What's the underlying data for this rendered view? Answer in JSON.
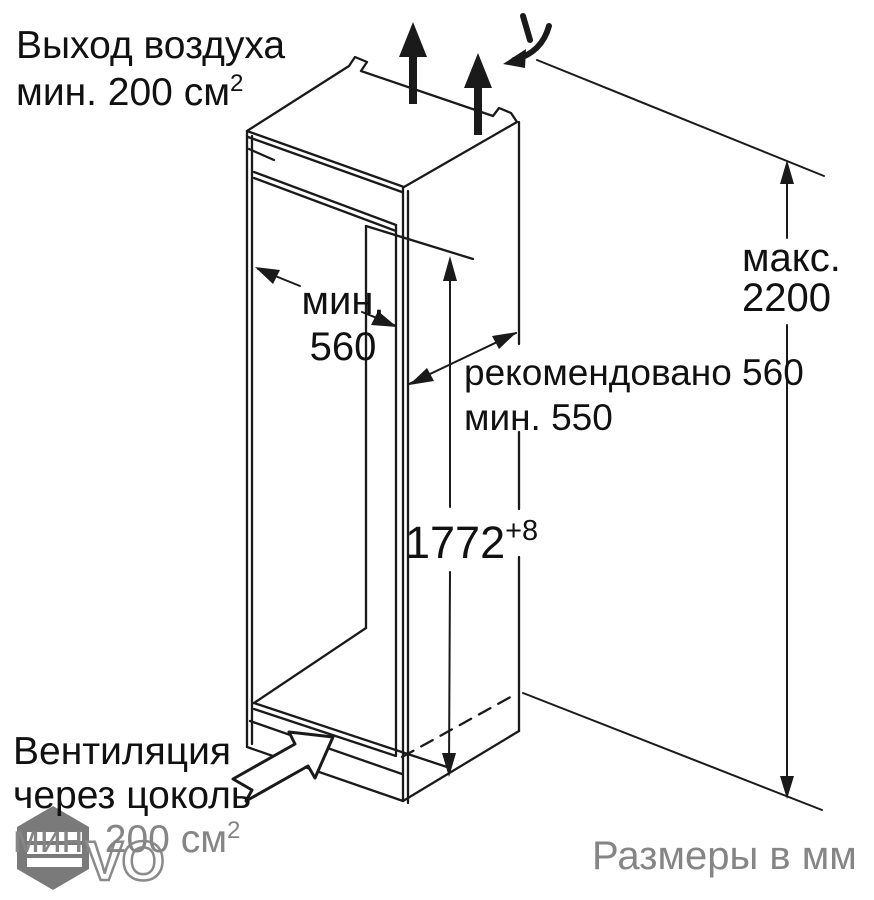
{
  "diagram_title": "Схема установки встраиваемого холодильника (ниша)",
  "units_note": "Размеры в мм",
  "annotations": {
    "air_outlet": {
      "line1": "Выход воздуха",
      "line2": "мин. 200 см",
      "sup": "2"
    },
    "niche_width": {
      "line1": "мин.",
      "line2": "560"
    },
    "niche_depth": {
      "line1": "рекомендовано 560",
      "line2": "мин. 550"
    },
    "niche_height": {
      "value": "1772",
      "tolerance": "+8"
    },
    "max_height": {
      "line1": "макс.",
      "line2": "2200"
    },
    "plinth_vent": {
      "line1": "Вентиляция",
      "line2": "через цоколь",
      "line3": "мин. 200 см",
      "sup": "2"
    }
  },
  "dimensions_mm": {
    "niche_width_min": 560,
    "niche_depth_recommended": 560,
    "niche_depth_min": 550,
    "niche_height": "1772 +8",
    "ceiling_height_max": 2200,
    "air_outlet_min_cm2": 200,
    "plinth_vent_min_cm2": 200
  },
  "watermark": {
    "letters": "VO"
  },
  "colors": {
    "line": "#1a1a1a",
    "gray_text": "#858585",
    "watermark_gray": "#7a7a7a",
    "background": "#ffffff"
  }
}
